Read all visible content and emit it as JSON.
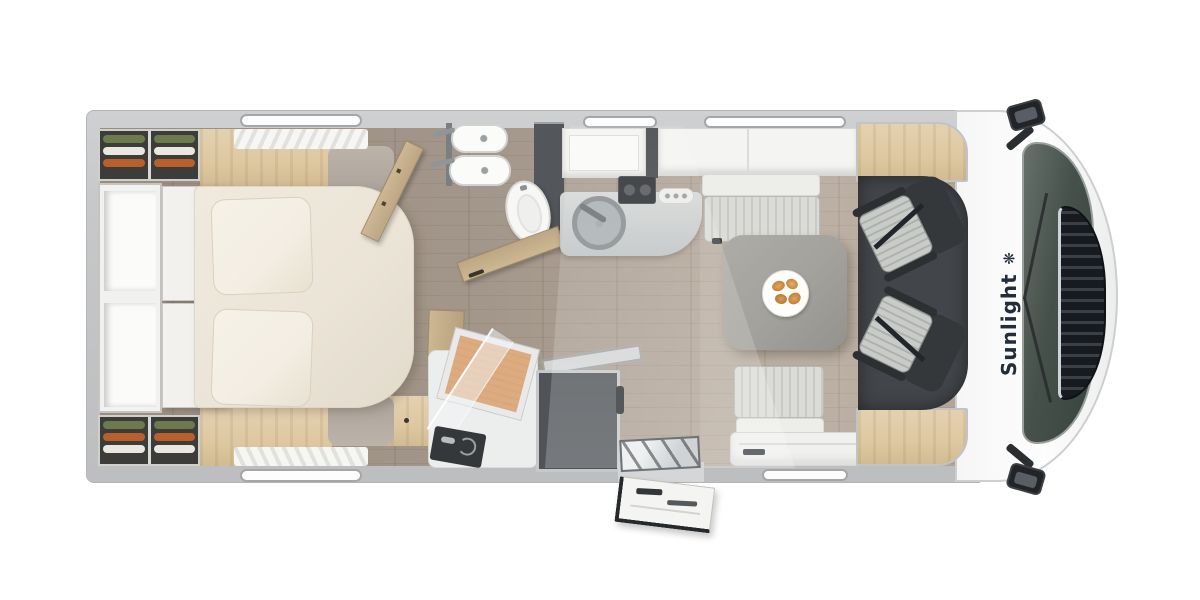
{
  "brand": {
    "label": "Sunlight",
    "icon_glyph": "❋",
    "icon_name": "sun-flower-icon"
  },
  "palette": {
    "background": "#ffffff",
    "wall": "#c6c7c8",
    "floor": "#a3968a",
    "floor_light": "#b7aa9c",
    "oak": "#ddc8a2",
    "bed": "#ebe4d7",
    "pillow": "#f3eee3",
    "bench": "#c9c9c5",
    "table": "#a3a19b",
    "dark_cabinet": "#53575b",
    "fridge": "#505458",
    "cab_floor": "#42464a",
    "seat_dark": "#34383b",
    "seat_stripe": "#c9cbc9",
    "windshield": "#46514b",
    "grille": "#171a1e",
    "shower_slat": "#d9a77c",
    "brand_text": "#232d39",
    "clothes": [
      "#6c7a4d",
      "#e9e7e0",
      "#b95f2c"
    ]
  }
}
